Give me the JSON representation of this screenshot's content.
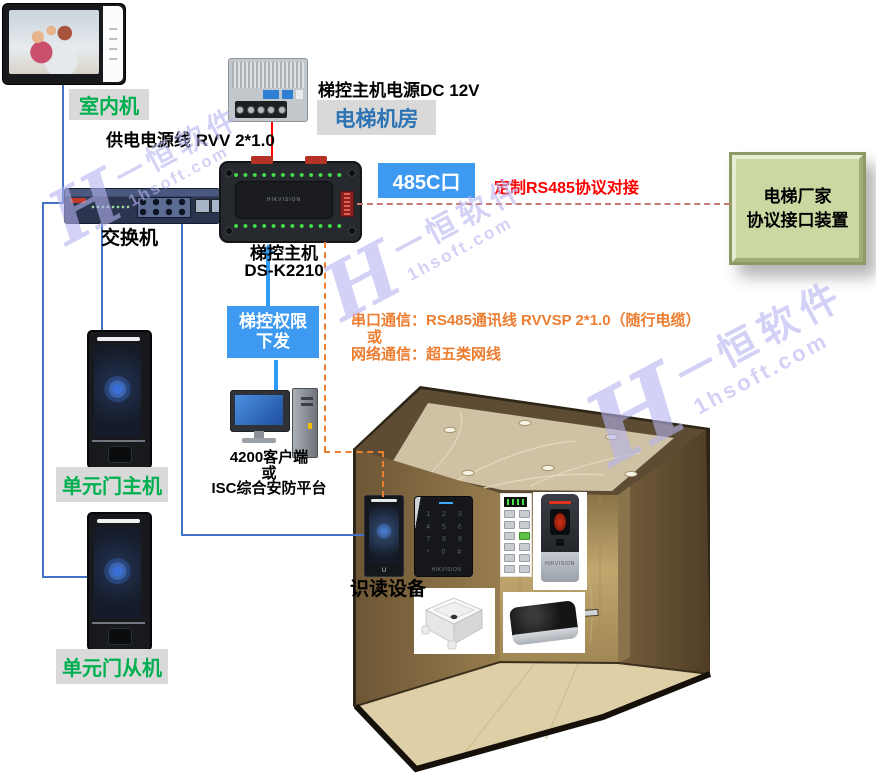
{
  "diagram": {
    "indoor": {
      "label": "室内机"
    },
    "psu": {
      "caption": "梯控主机电源DC 12V"
    },
    "machine_room": {
      "label": "电梯机房"
    },
    "power_cable": {
      "label": "供电电源线 RVV 2*1.0"
    },
    "switch": {
      "label": "交换机"
    },
    "controller": {
      "name": "梯控主机",
      "model": "DS-K2210",
      "brand": "HIKVISION"
    },
    "port485": {
      "label": "485C口"
    },
    "rs485": {
      "note": "定制RS485协议对接"
    },
    "vendor": {
      "line1": "电梯厂家",
      "line2": "协议接口装置"
    },
    "permission": {
      "line1": "梯控权限",
      "line2": "下发"
    },
    "client": {
      "line1": "4200客户端",
      "line2": "或",
      "line3": "ISC综合安防平台"
    },
    "comm": {
      "line1": "串口通信：RS485通讯线  RVVSP 2*1.0（随行电缆）",
      "line2": "或",
      "line3": "网络通信：超五类网线"
    },
    "door_master": {
      "label": "单元门主机"
    },
    "door_slave": {
      "label": "单元门从机"
    },
    "readers": {
      "label": "识读设备"
    },
    "keypad": {
      "row1": "1 2 3",
      "row2": "4 5 6",
      "row3": "7 8 9",
      "row4": "* 0 #",
      "brand": "HIKVISION"
    },
    "fingerprint": {
      "brand": "HIKVISION"
    }
  },
  "watermark": {
    "logo": "H",
    "brand": "一恒软件",
    "domain": "1hsoft.com"
  },
  "colors": {
    "line_blue": "#4472c4",
    "line_red": "#ff0000",
    "dash_orange": "#ed7d31",
    "dash_salmon": "#c97a72",
    "badge_blue": "#3d9af0",
    "text_green": "#00b050",
    "text_blue": "#2e74b5",
    "text_red": "#ff0000",
    "text_orange": "#ed7d31",
    "vendor_green": "#cbd8a2",
    "label_gray": "#d9d9d9",
    "watermark": "#b6b4ef"
  }
}
